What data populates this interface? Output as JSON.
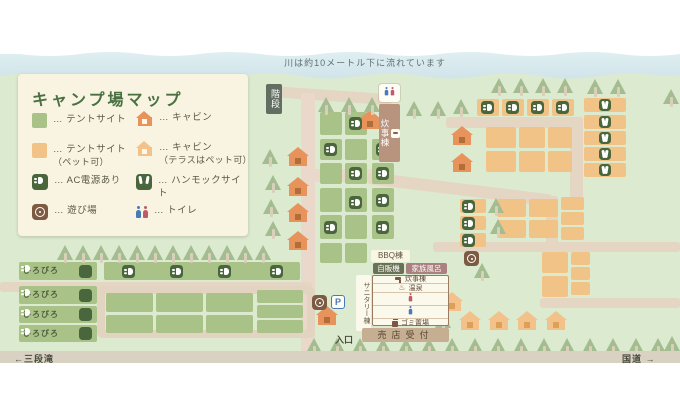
{
  "page": {
    "river_note": "川は約10メートル下に流れています",
    "bottom_left": "←三段滝",
    "bottom_right": "国道 →"
  },
  "legend": {
    "title": "キャンプ場マップ",
    "items": [
      {
        "icon": "tent-site-swatch",
        "label": "… テントサイト"
      },
      {
        "icon": "cabin-icon",
        "label": "… キャビン"
      },
      {
        "icon": "tent-site-pet-swatch",
        "label": "… テントサイト",
        "sub": "（ペット可）"
      },
      {
        "icon": "cabin-pet-icon",
        "label": "… キャビン",
        "sub": "（テラスはペット可）"
      },
      {
        "icon": "ac-power-icon",
        "label": "… AC電源あり"
      },
      {
        "icon": "hammock-site-icon",
        "label": "… ハンモックサイト"
      },
      {
        "icon": "playground-icon",
        "label": "… 遊び場"
      },
      {
        "icon": "toilet-icon",
        "label": "… トイレ"
      }
    ]
  },
  "map_labels": {
    "stairs": "階段",
    "cooking_annex": "炊事棟",
    "bbq": "BBQ棟",
    "vending": "自販機",
    "family_bath": "家族風呂",
    "sanitary": "サニタリー棟",
    "shop_reception": "売店受付",
    "entrance": "入口",
    "hirobiro": "ひろびろ",
    "parking": "P"
  },
  "sanitary_detail": {
    "rows": [
      {
        "icon": "faucet-icon",
        "label": "炊事棟"
      },
      {
        "icon": "onsen-icon",
        "label": "温泉"
      },
      {
        "icon": "woman-icon",
        "label": ""
      },
      {
        "icon": "man-icon",
        "label": ""
      },
      {
        "icon": "trash-icon",
        "label": "ゴミ置場"
      }
    ]
  },
  "icons": {
    "onsen": "♨"
  },
  "colors": {
    "map_bg": "#dcead0",
    "river": "#d6e8ec",
    "site_green": "#a9c288",
    "site_orange": "#f2c387",
    "road": "#e5d6c3",
    "badge_green": "#4a663d",
    "cabin": "#e8935c",
    "cabin_pet": "#f3c28b",
    "playground_brown": "#7d5b43",
    "legend_bg": "#f8f4e1",
    "bottom_band": "#d9d2c3"
  }
}
